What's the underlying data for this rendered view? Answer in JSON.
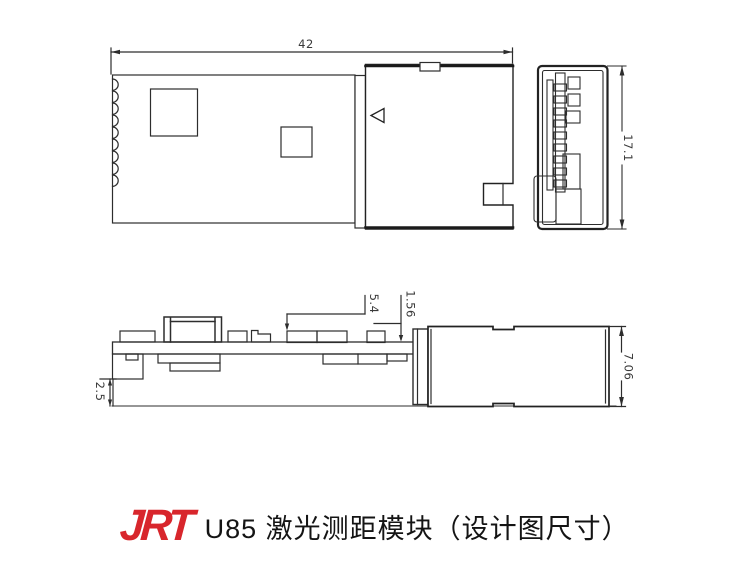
{
  "caption": {
    "logo_text": "JRT",
    "logo_color": "#d8262c",
    "title": "U85 激光测距模块（设计图尺寸）"
  },
  "views": {
    "top_view": {
      "width_dim": "42"
    },
    "end_view": {
      "height_dim": "17.1"
    },
    "side_view": {
      "length_dim": "5.4",
      "gap_dim": "1.56",
      "bottom_dim": "2.5",
      "height_dim": "7.06"
    }
  },
  "colors": {
    "line": "#2d2d2d",
    "accent": "#d8262c",
    "background": "#ffffff"
  }
}
